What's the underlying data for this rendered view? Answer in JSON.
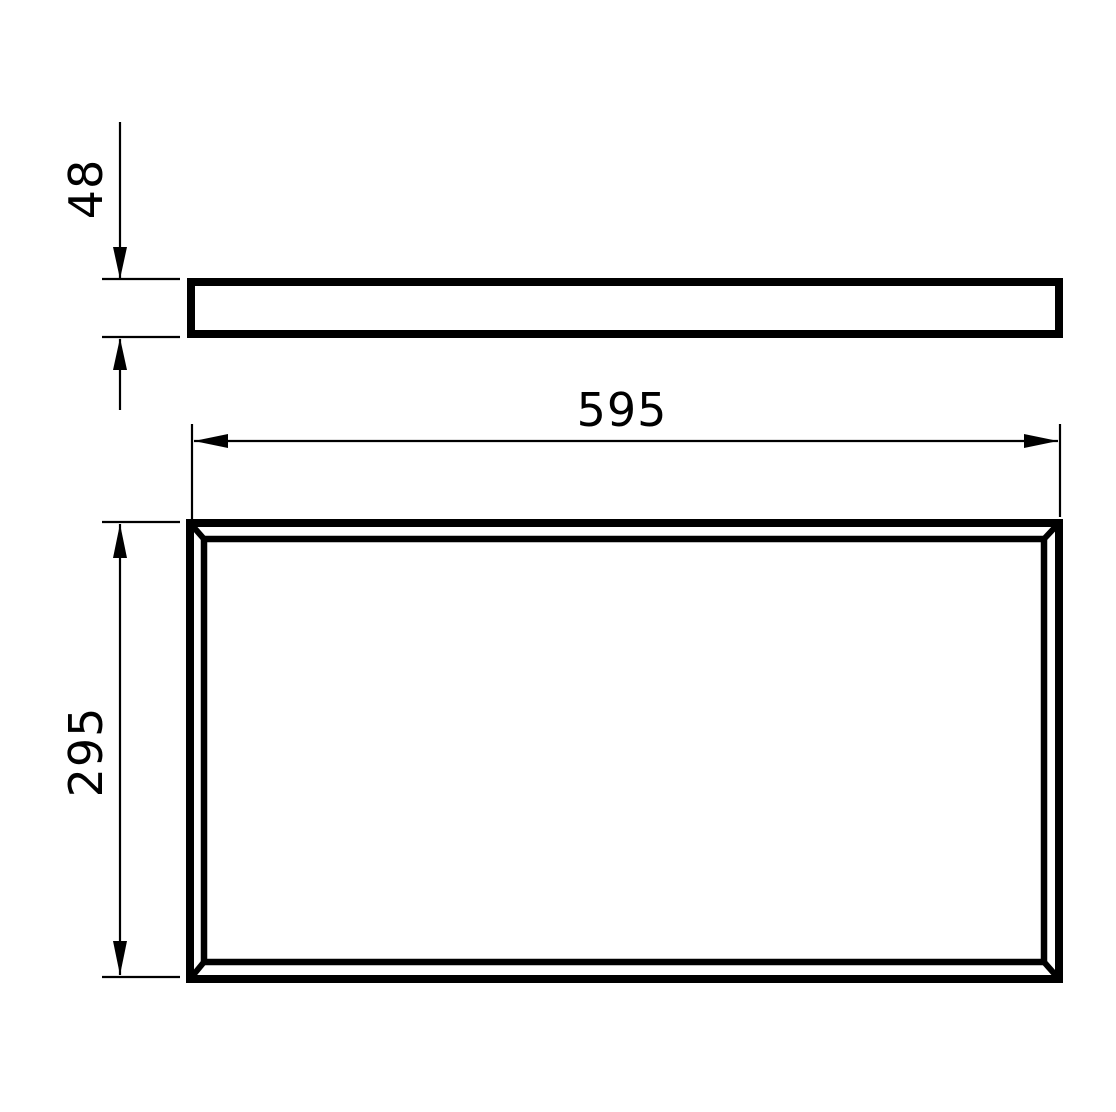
{
  "drawing": {
    "type": "technical-dimension-drawing",
    "dimensions": {
      "width_label": "595",
      "height_label": "295",
      "thickness_label": "48"
    },
    "colors": {
      "line": "#000000",
      "background": "#ffffff"
    }
  }
}
